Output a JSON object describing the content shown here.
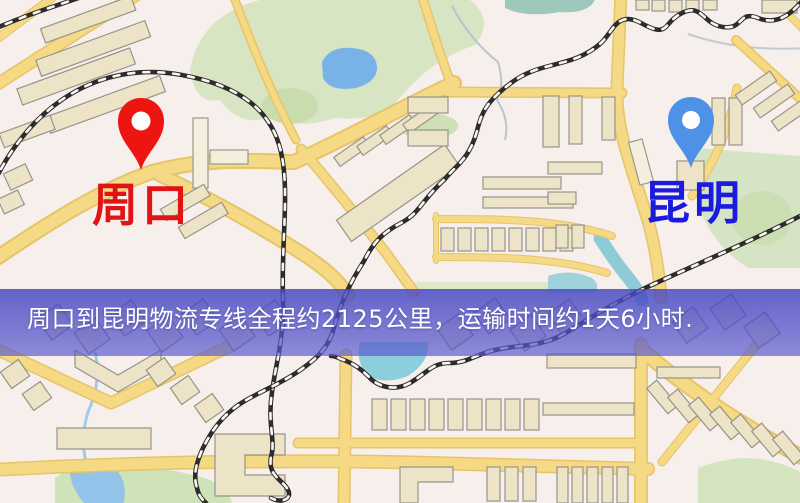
{
  "page": {
    "kind": "logistics-route-map",
    "width_px": 800,
    "height_px": 503
  },
  "banner": {
    "text": "周口到昆明物流专线全程约2125公里，运输时间约1天6小时.",
    "text_color": "#ffffff",
    "background_color": "#4a4cc4"
  },
  "route": {
    "origin": "周口",
    "destination": "昆明",
    "service": "物流专线",
    "distance": "约2125公里",
    "duration": "约1天6小时"
  },
  "map": {
    "origin_marker": {
      "label": "周口",
      "label_color": "#e01414",
      "pin_color": "#ee1412"
    },
    "destination_marker": {
      "label": "昆明",
      "label_color": "#1b1bdf",
      "pin_color": "#4e92e8"
    },
    "colors": {
      "background": "#f7efec",
      "road_fill": "#f6d985",
      "road_border": "#e6c468",
      "building_fill": "#ede3c6",
      "building_outline": "#97948a",
      "park_green": "#d7e5c2",
      "lake_blue": "#78b2e6",
      "river_teal": "#8ccfdc",
      "railway_dark": "#2e2c2a"
    }
  }
}
